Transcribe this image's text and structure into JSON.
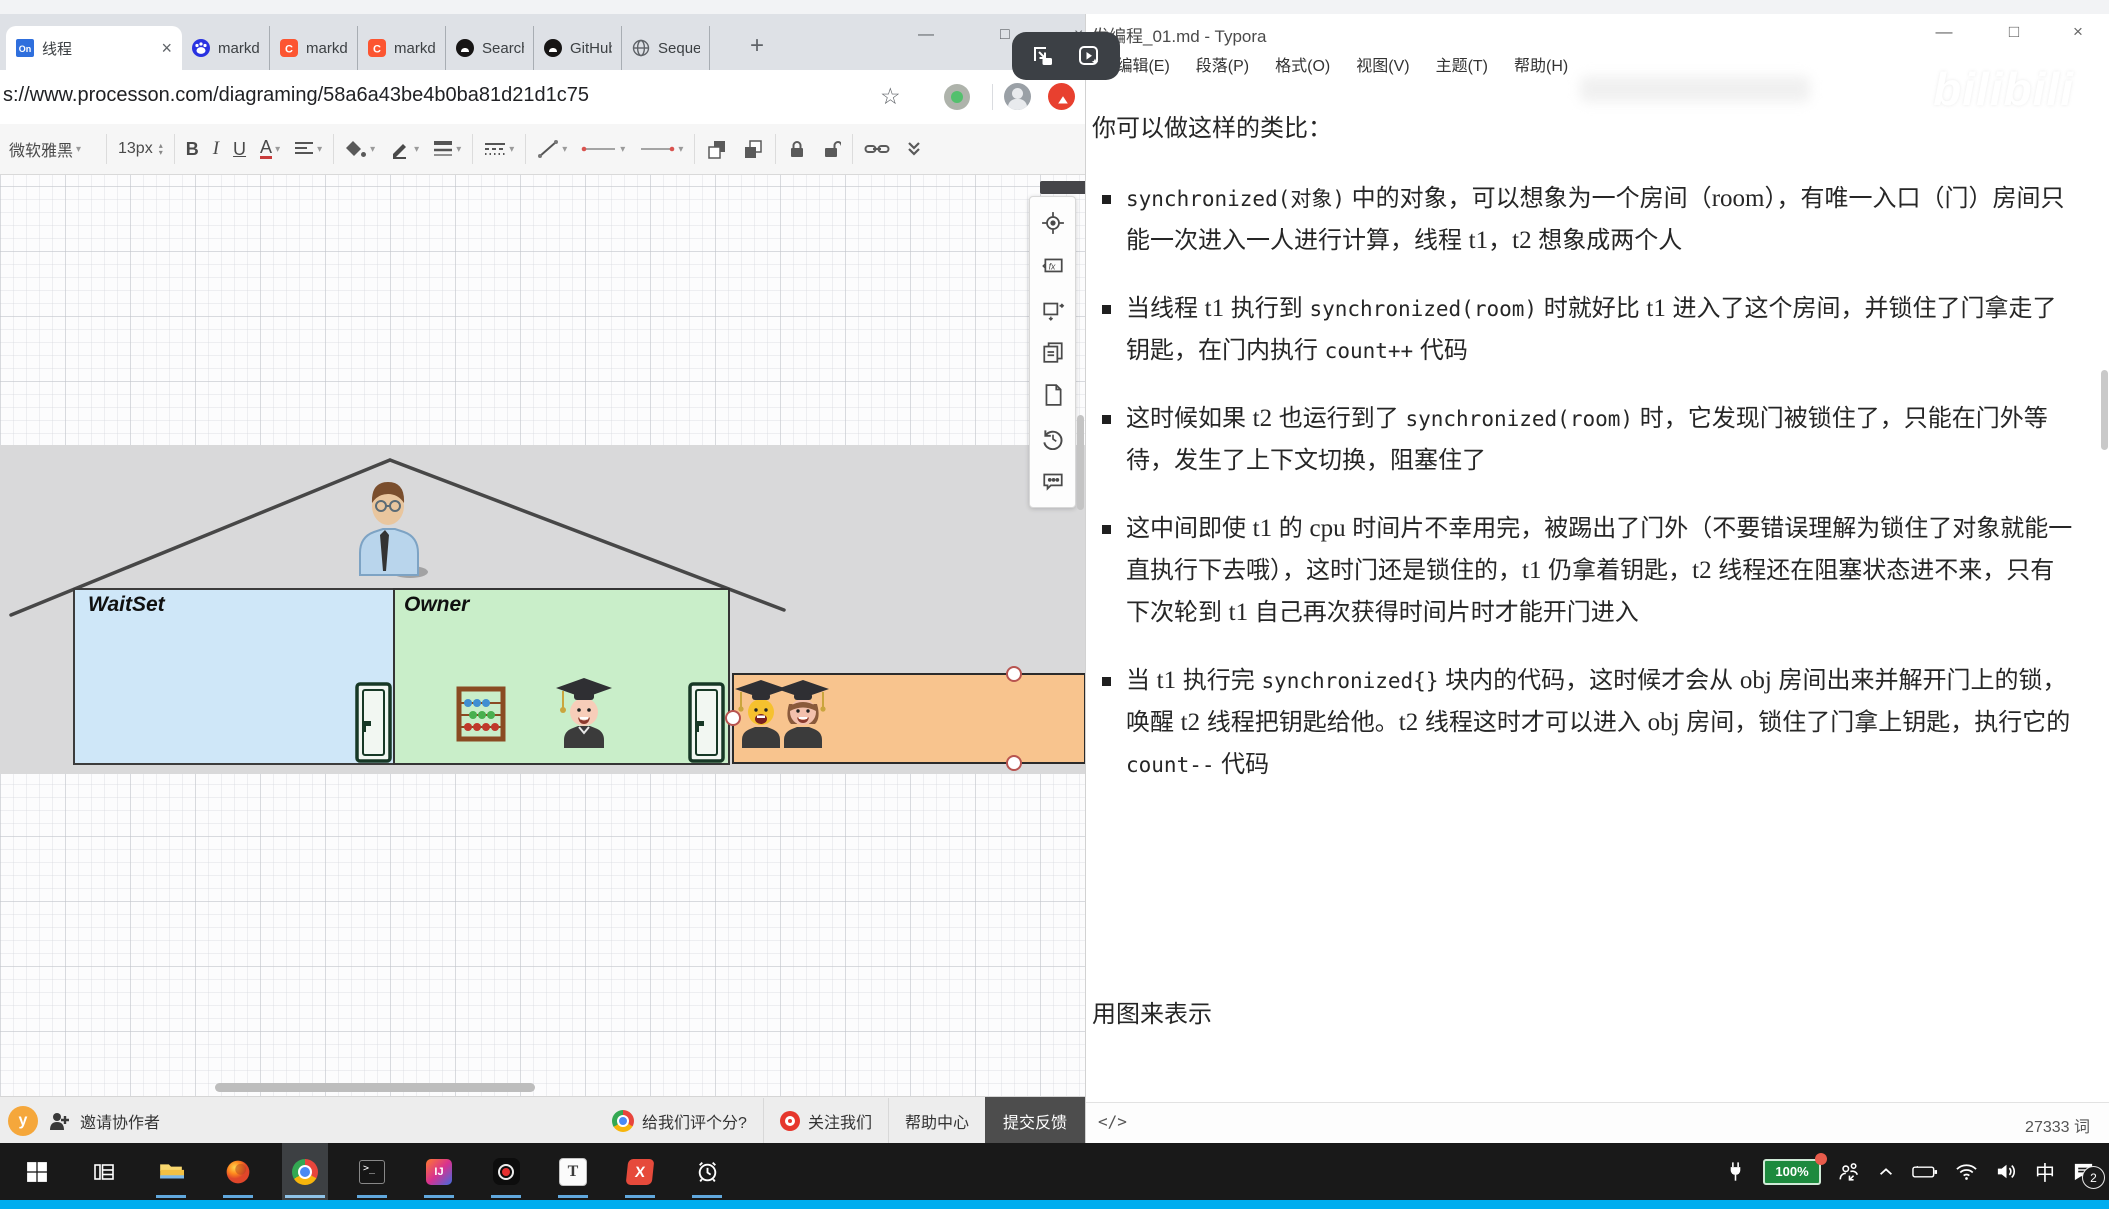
{
  "browser": {
    "tabs": [
      {
        "label": "线程",
        "icon": "processon",
        "active": true
      },
      {
        "label": "markdo",
        "icon": "baidu"
      },
      {
        "label": "markdo",
        "icon": "csdn"
      },
      {
        "label": "markdo",
        "icon": "csdn"
      },
      {
        "label": "Search",
        "icon": "github"
      },
      {
        "label": "GitHub",
        "icon": "github"
      },
      {
        "label": "Sequen",
        "icon": "globe"
      }
    ],
    "url": "s://www.processon.com/diagraming/58a6a43be4b0ba81d21d1c75",
    "toolbar": {
      "font": "微软雅黑",
      "size": "13px"
    },
    "bottom_bar": {
      "avatar": "y",
      "invite": "邀请协作者",
      "rate": "给我们评个分?",
      "follow": "关注我们",
      "help": "帮助中心",
      "feedback": "提交反馈"
    }
  },
  "diagram": {
    "waitset_label": "WaitSet",
    "owner_label": "Owner",
    "colors": {
      "waitset_fill": "#cfe7f8",
      "owner_fill": "#c9eec9",
      "entry_fill": "#f8c48e",
      "band": "#d9d9da",
      "selection_handle": "#b85450"
    }
  },
  "typora": {
    "title": "发编程_01.md - Typora",
    "menus": [
      "文件(F)",
      "编辑(E)",
      "段落(P)",
      "格式(O)",
      "视图(V)",
      "主题(T)",
      "帮助(H)"
    ],
    "paragraphs": [
      {
        "type": "p",
        "segments": [
          {
            "t": "你可以做这样的类比：",
            "c": "p"
          }
        ]
      },
      {
        "type": "li",
        "segments": [
          {
            "t": "synchronized(对象)",
            "c": "code"
          },
          {
            "t": " 中的对象，可以想象为一个房间（",
            "c": "p"
          },
          {
            "t": "room",
            "c": "lat"
          },
          {
            "t": "），有唯一入口（门）房间只能一次进入一人进行计算，线程 ",
            "c": "p"
          },
          {
            "t": "t1",
            "c": "lat"
          },
          {
            "t": "，",
            "c": "p"
          },
          {
            "t": "t2",
            "c": "lat"
          },
          {
            "t": " 想象成两个人",
            "c": "p"
          }
        ]
      },
      {
        "type": "li",
        "segments": [
          {
            "t": "当线程 ",
            "c": "p"
          },
          {
            "t": "t1",
            "c": "lat"
          },
          {
            "t": " 执行到 ",
            "c": "p"
          },
          {
            "t": "synchronized(room)",
            "c": "code"
          },
          {
            "t": " 时就好比 ",
            "c": "p"
          },
          {
            "t": "t1",
            "c": "lat"
          },
          {
            "t": " 进入了这个房间，并锁住了门拿走了钥匙，在门内执行 ",
            "c": "p"
          },
          {
            "t": "count++",
            "c": "code"
          },
          {
            "t": " 代码",
            "c": "p"
          }
        ]
      },
      {
        "type": "li",
        "segments": [
          {
            "t": "这时候如果 ",
            "c": "p"
          },
          {
            "t": "t2",
            "c": "lat"
          },
          {
            "t": " 也运行到了 ",
            "c": "p"
          },
          {
            "t": "synchronized(room)",
            "c": "code"
          },
          {
            "t": " 时，它发现门被锁住了，只能在门外等待，发生了上下文切换，阻塞住了",
            "c": "p"
          }
        ]
      },
      {
        "type": "li",
        "segments": [
          {
            "t": "这中间即使 ",
            "c": "p"
          },
          {
            "t": "t1",
            "c": "lat"
          },
          {
            "t": " 的 ",
            "c": "p"
          },
          {
            "t": "cpu",
            "c": "lat"
          },
          {
            "t": " 时间片不幸用完，被踢出了门外（不要错误理解为锁住了对象就能一直执行下去哦），这时门还是锁住的，",
            "c": "p"
          },
          {
            "t": "t1",
            "c": "lat"
          },
          {
            "t": " 仍拿着钥匙，",
            "c": "p"
          },
          {
            "t": "t2",
            "c": "lat"
          },
          {
            "t": " 线程还在阻塞状态进不来，只有下次轮到 ",
            "c": "p"
          },
          {
            "t": "t1",
            "c": "lat"
          },
          {
            "t": " 自己再次获得时间片时才能开门进入",
            "c": "p"
          }
        ]
      },
      {
        "type": "li",
        "segments": [
          {
            "t": "当 ",
            "c": "p"
          },
          {
            "t": "t1",
            "c": "lat"
          },
          {
            "t": " 执行完 ",
            "c": "p"
          },
          {
            "t": "synchronized{}",
            "c": "code"
          },
          {
            "t": " 块内的代码，这时候才会从 ",
            "c": "p"
          },
          {
            "t": "obj",
            "c": "lat"
          },
          {
            "t": " 房间出来并解开门上的锁，唤醒 ",
            "c": "p"
          },
          {
            "t": "t2",
            "c": "lat"
          },
          {
            "t": " 线程把钥匙给他。",
            "c": "p"
          },
          {
            "t": "t2",
            "c": "lat"
          },
          {
            "t": " 线程这时才可以进入 ",
            "c": "p"
          },
          {
            "t": "obj",
            "c": "lat"
          },
          {
            "t": " 房间，锁住了门拿上钥匙，执行它的 ",
            "c": "p"
          },
          {
            "t": "count--",
            "c": "code"
          },
          {
            "t": " 代码",
            "c": "p"
          }
        ]
      },
      {
        "type": "p",
        "gap": true,
        "segments": [
          {
            "t": "用图来表示",
            "c": "p"
          }
        ]
      }
    ],
    "word_count": "27333 词",
    "source_toggle": "</>"
  },
  "watermark": "bilibili",
  "taskbar": {
    "items": [
      {
        "name": "start"
      },
      {
        "name": "task-view"
      },
      {
        "name": "file-explorer",
        "underline": true
      },
      {
        "name": "firefox",
        "underline": true
      },
      {
        "name": "chrome",
        "underline": true,
        "active": true
      },
      {
        "name": "terminal",
        "underline": true
      },
      {
        "name": "intellij",
        "underline": true
      },
      {
        "name": "screen-recorder",
        "underline": true
      },
      {
        "name": "typora",
        "underline": true
      },
      {
        "name": "xmind",
        "underline": true
      },
      {
        "name": "alarm-clock",
        "underline": true
      }
    ]
  },
  "tray": {
    "items": [
      "power-plug",
      "battery-green",
      "people",
      "chevron-up",
      "battery",
      "wifi",
      "volume",
      "ime",
      "notifications"
    ],
    "battery": "100%",
    "ime": "中",
    "badge": "2"
  },
  "icons": {
    "minimize": "—",
    "maximize": "□",
    "close": "×",
    "star": "☆",
    "new_tab": "+",
    "tab_close": "×",
    "caret": "▾",
    "step_up": "▴",
    "step_down": "▾"
  }
}
